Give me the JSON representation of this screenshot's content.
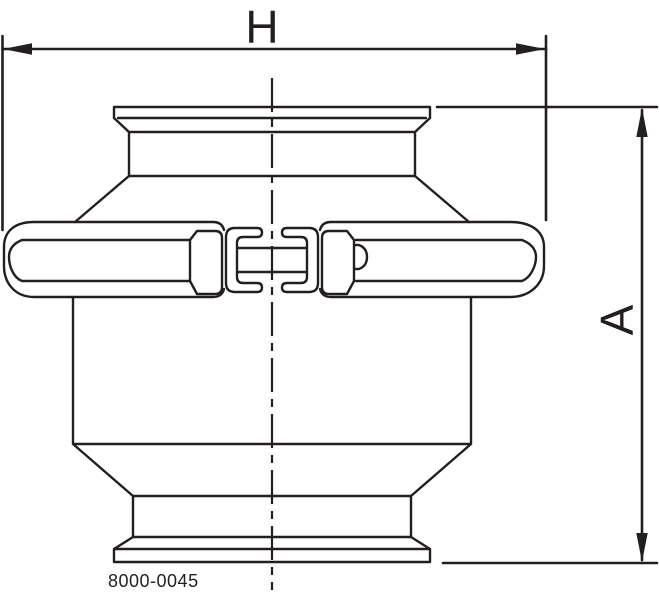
{
  "drawing": {
    "dimension_h_label": "H",
    "dimension_a_label": "A",
    "part_number": "8000-0045",
    "line_color": "#231f20",
    "background_color": "#ffffff"
  }
}
